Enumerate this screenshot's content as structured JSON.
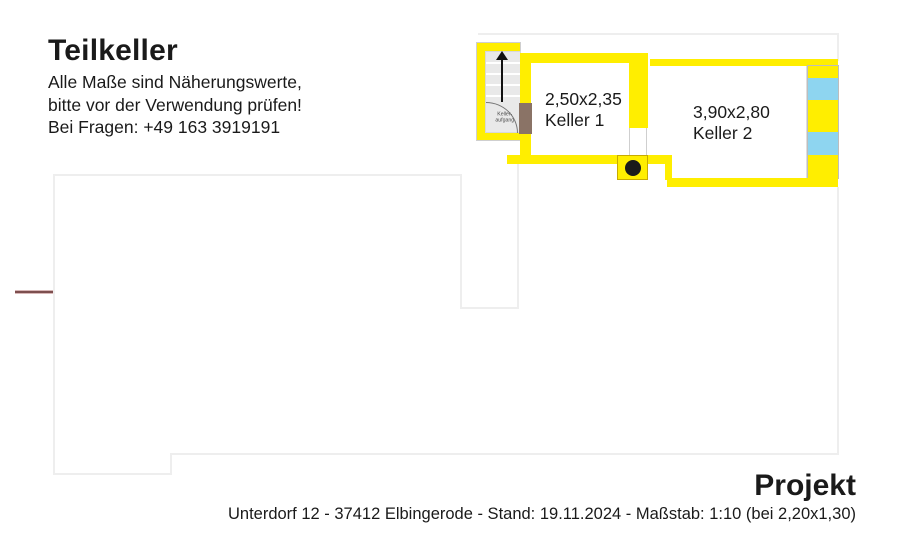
{
  "header": {
    "title": "Teilkeller",
    "notes": [
      "Alle Maße sind Näherungswerte,",
      "bitte vor der Verwendung prüfen!",
      "Bei Fragen: +49 163 3919191"
    ]
  },
  "plan": {
    "stairs": {
      "label_line1": "Keller-",
      "label_line2": "aufgang",
      "direction_icon": "arrow-up-icon"
    },
    "rooms": [
      {
        "dimensions": "2,50x2,35",
        "name": "Keller 1"
      },
      {
        "dimensions": "3,90x2,80",
        "name": "Keller 2"
      }
    ],
    "colors": {
      "wall_yellow": "#ffee00",
      "glass_blue": "#8ed5f0",
      "stair_gray": "#e9e9e9",
      "door_brown": "#8a7366",
      "outline_gray": "#eeeeee",
      "marker_red": "#7d4f4f"
    }
  },
  "footer": {
    "project_label": "Projekt",
    "details": "Unterdorf 12 - 37412 Elbingerode - Stand: 19.11.2024 - Maßstab: 1:10 (bei 2,20x1,30)"
  }
}
